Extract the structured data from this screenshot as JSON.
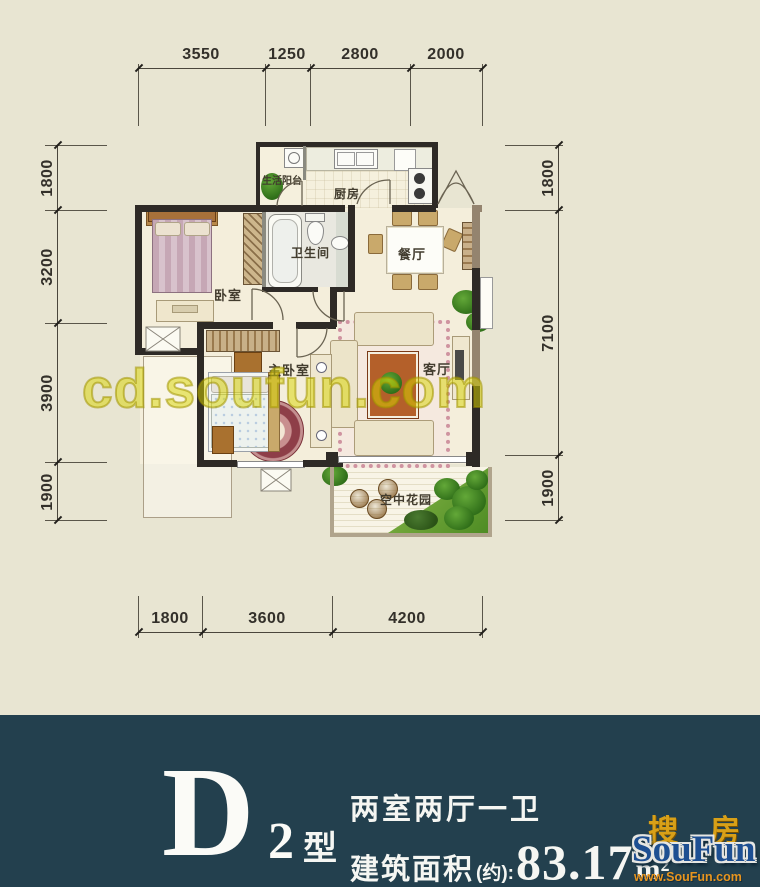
{
  "watermark": "cd.soufun.com",
  "dimensions": {
    "top": [
      "3550",
      "1250",
      "2800",
      "2000"
    ],
    "left": [
      "1800",
      "3200",
      "3900",
      "1900"
    ],
    "right": [
      "1800",
      "7100",
      "1900"
    ],
    "bottom": [
      "1800",
      "3600",
      "4200"
    ]
  },
  "rooms": {
    "living_balcony": "生活阳台",
    "kitchen": "厨房",
    "bathroom": "卫生间",
    "dining_room": "餐厅",
    "bedroom": "卧室",
    "master_bedroom": "主卧室",
    "living_room": "客厅",
    "sky_garden": "空中花园"
  },
  "footer": {
    "plan_letter": "D",
    "plan_number": "2",
    "type_suffix": "型",
    "layout_desc": "两室两厅一卫",
    "area_label": "建筑面积",
    "area_approx": "(约):",
    "area_value": "83.17",
    "area_unit": "m²"
  },
  "logo": {
    "cn": "搜房",
    "en": "SouFun",
    "site": "www.SouFun.com"
  },
  "colors": {
    "page_background": "#e8e5d2",
    "footer_background": "#23404e",
    "watermark_yellow": "#d8d400",
    "wall_dark": "#2e2a26",
    "wall_tan": "#94846f",
    "floor_cream": "#f4eedb",
    "footer_text": "#f5f6f2",
    "logo_blue": "#1d4f92",
    "logo_gold": "#d8a018"
  }
}
